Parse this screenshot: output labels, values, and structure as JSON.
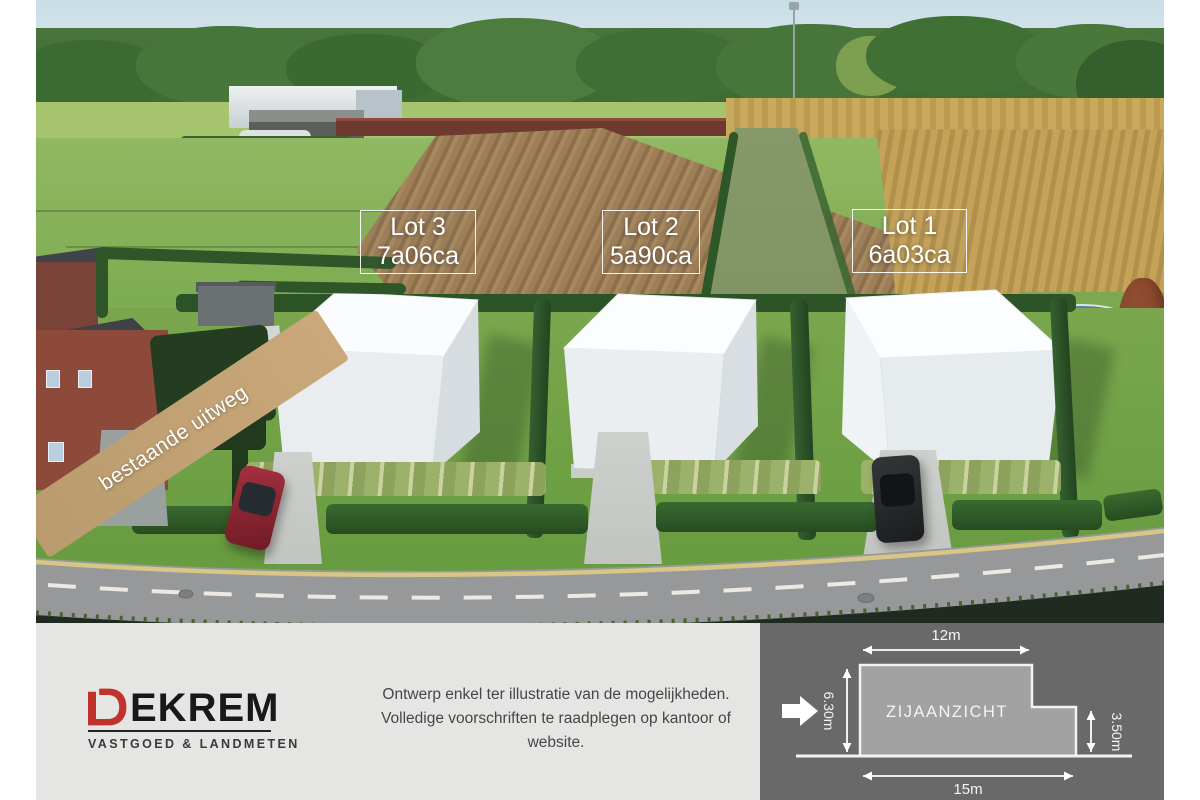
{
  "lots": [
    {
      "name": "Lot 3",
      "area": "7a06ca"
    },
    {
      "name": "Lot 2",
      "area": "5a90ca"
    },
    {
      "name": "Lot 1",
      "area": "6a03ca"
    }
  ],
  "photo": {
    "path_label": "bestaande uitweg"
  },
  "footer": {
    "logo": {
      "d": "D",
      "rest": "EKREM",
      "tagline": "VASTGOED & LANDMETEN",
      "red": "#c0322b"
    },
    "disclaimer": {
      "lines": [
        "Ontwerp enkel ter illustratie van de mogelijkheden.",
        "Volledige voorschriften te raadplegen op kantoor of",
        "website."
      ]
    },
    "diagram": {
      "title": "ZIJAANZICHT",
      "dim_top": "12m",
      "dim_bottom": "15m",
      "dim_left": "6.30m",
      "dim_right": "3.50m",
      "panel_color": "#696969",
      "shape_color": "#a2a2a2"
    }
  }
}
